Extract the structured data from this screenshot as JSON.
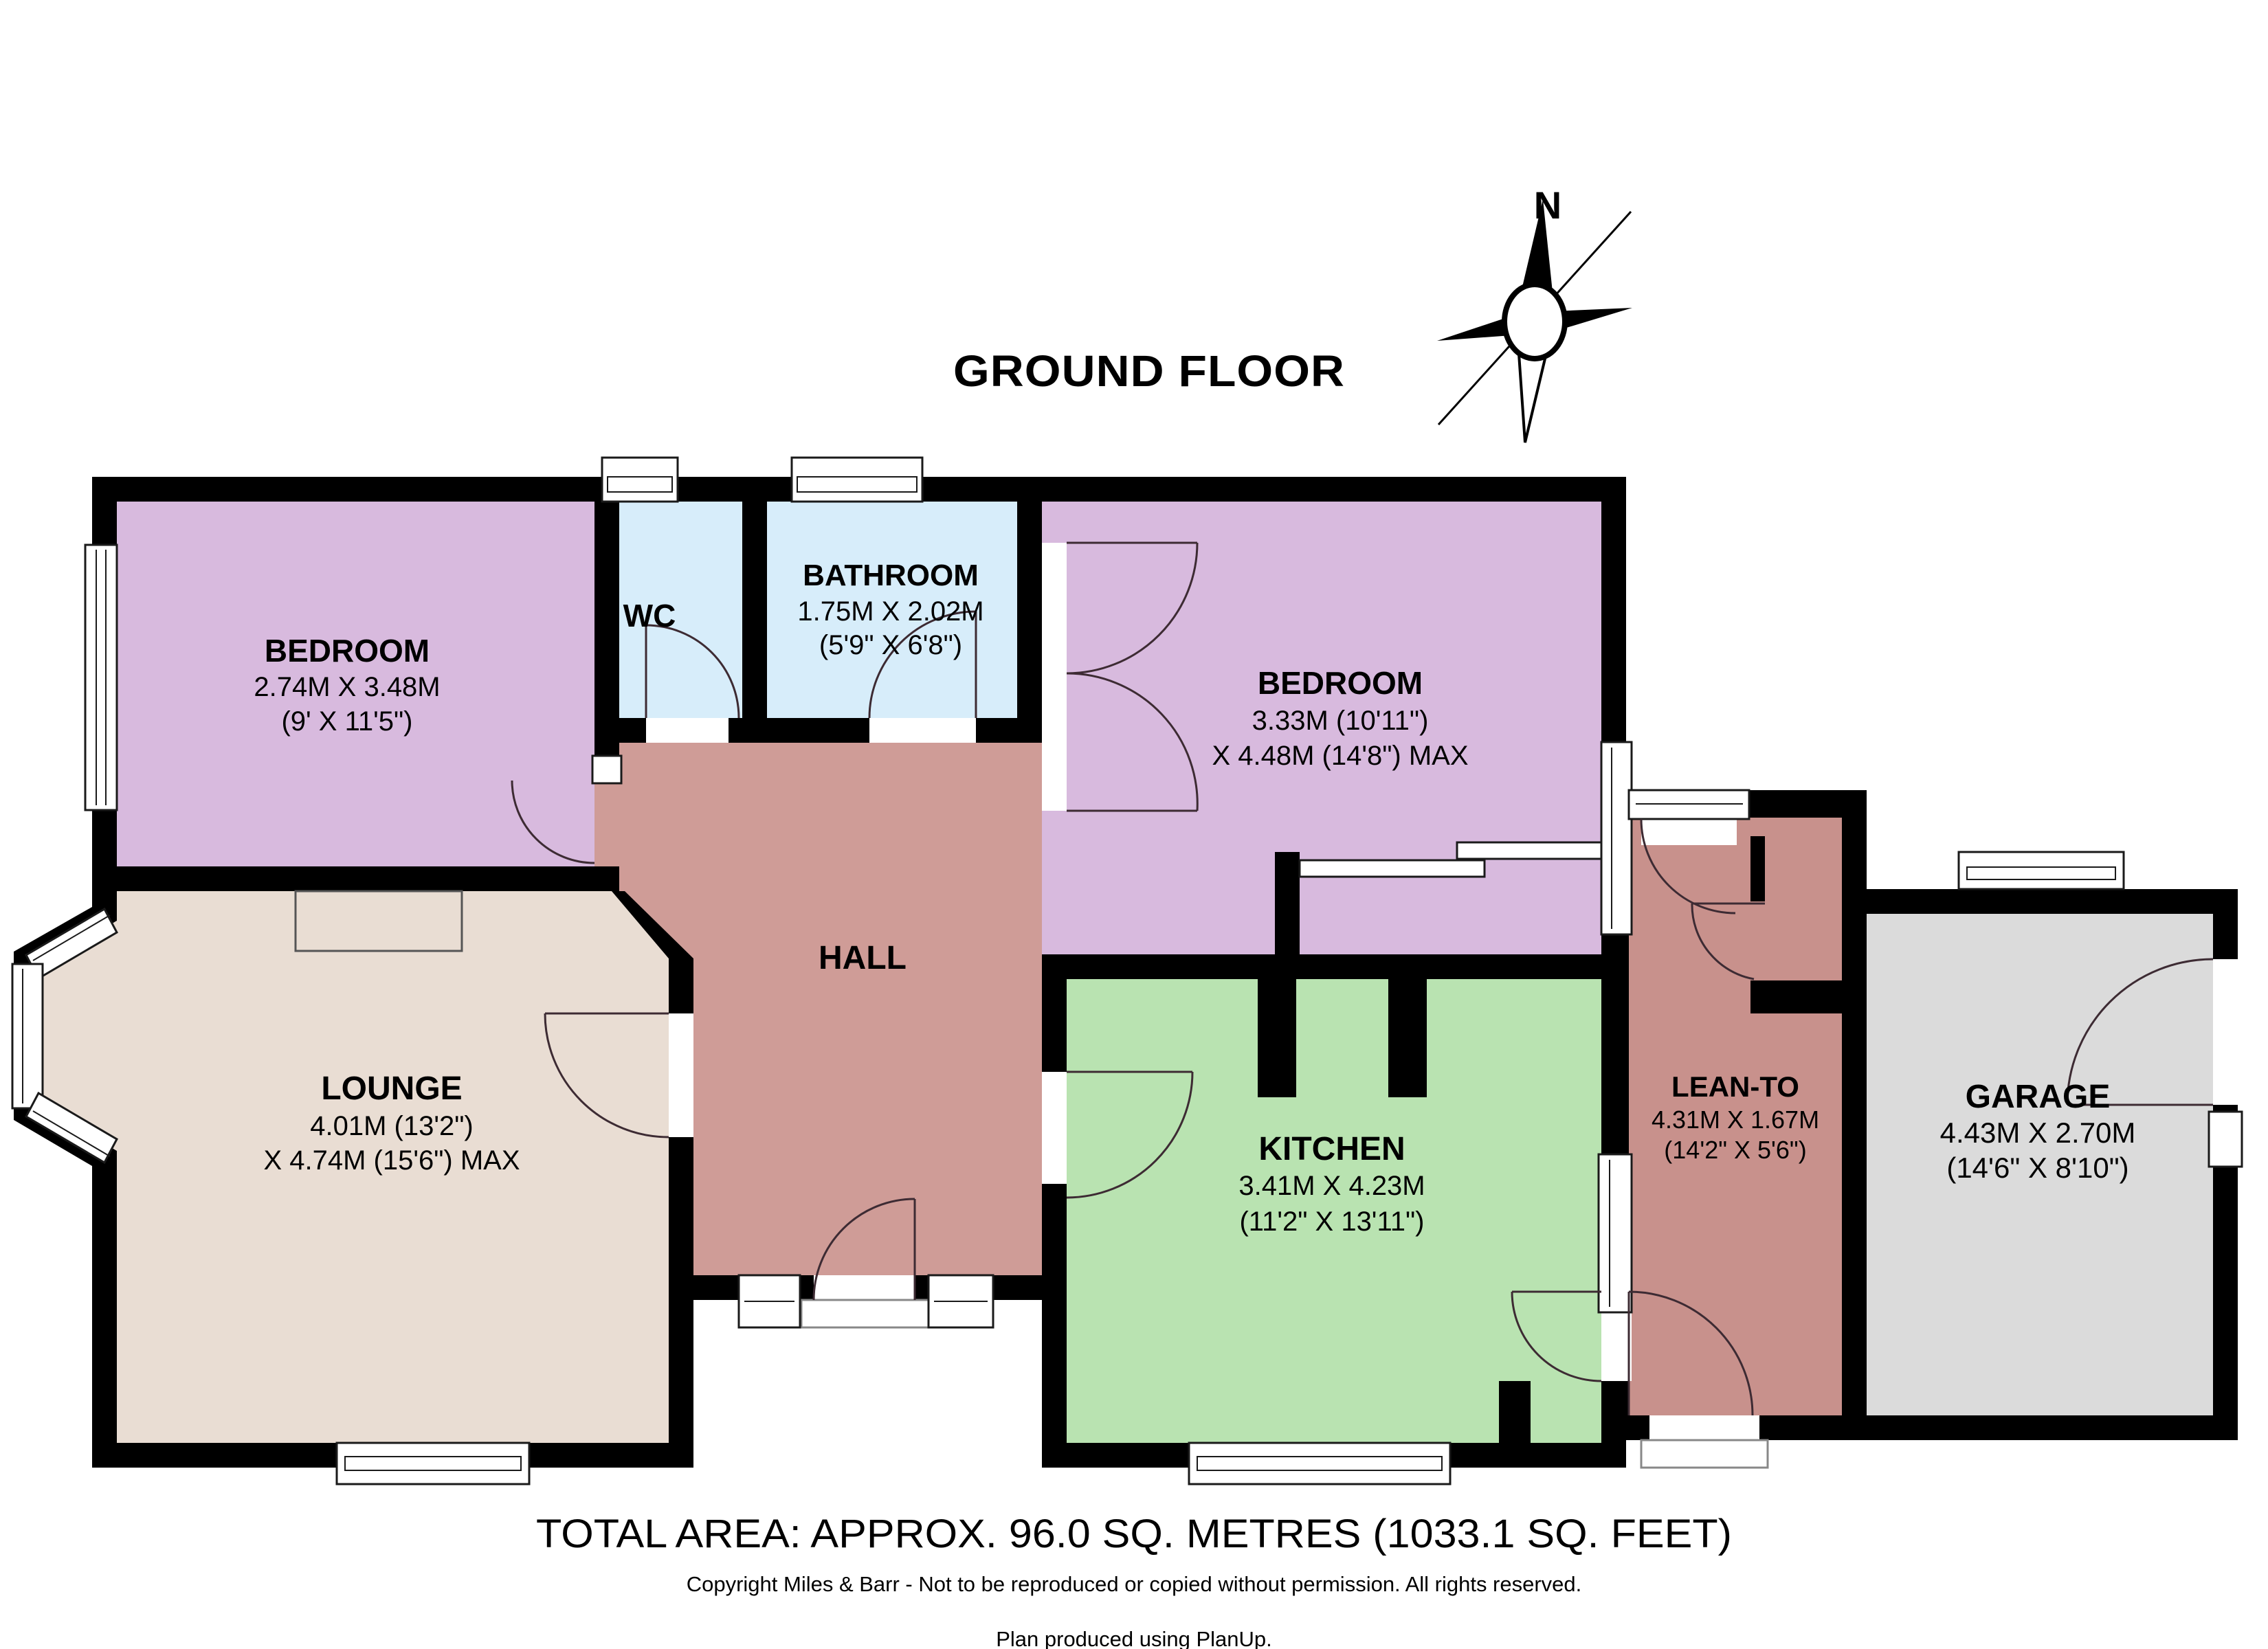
{
  "title": "GROUND FLOOR",
  "compass": {
    "north_label": "N"
  },
  "rooms": [
    {
      "id": "bedroom-left",
      "name": "BEDROOM",
      "dim_line1": "2.74M X 3.48M",
      "dim_line2": "(9' X 11'5\")"
    },
    {
      "id": "wc",
      "name": "WC"
    },
    {
      "id": "bathroom",
      "name": "BATHROOM",
      "dim_line1": "1.75M X 2.02M",
      "dim_line2": "(5'9\" X 6'8\")"
    },
    {
      "id": "bedroom-right",
      "name": "BEDROOM",
      "dim_line1": "3.33M (10'11\")",
      "dim_line2": "X 4.48M (14'8\") MAX"
    },
    {
      "id": "hall",
      "name": "HALL"
    },
    {
      "id": "lounge",
      "name": "LOUNGE",
      "dim_line1": "4.01M (13'2\")",
      "dim_line2": "X 4.74M (15'6\") MAX"
    },
    {
      "id": "kitchen",
      "name": "KITCHEN",
      "dim_line1": "3.41M X 4.23M",
      "dim_line2": "(11'2\" X 13'11\")"
    },
    {
      "id": "lean-to",
      "name": "LEAN-TO",
      "dim_line1": "4.31M X 1.67M",
      "dim_line2": "(14'2\" X 5'6\")"
    },
    {
      "id": "garage",
      "name": "GARAGE",
      "dim_line1": "4.43M X 2.70M",
      "dim_line2": "(14'6\" X 8'10\")"
    }
  ],
  "footer": {
    "total_area": "TOTAL AREA: APPROX. 96.0 SQ. METRES (1033.1 SQ. FEET)",
    "copyright": "Copyright Miles & Barr - Not to be reproduced or copied without permission. All rights reserved.",
    "produced_with": "Plan produced using PlanUp."
  },
  "colors": {
    "wall": "#000000",
    "bedroom": "#d8bade",
    "bathroom": "#d7edfa",
    "hall": "#cf9c97",
    "lounge": "#e9ddd3",
    "kitchen": "#b9e3b1",
    "lean_to": "#c8918c",
    "garage": "#dbdbdb"
  }
}
